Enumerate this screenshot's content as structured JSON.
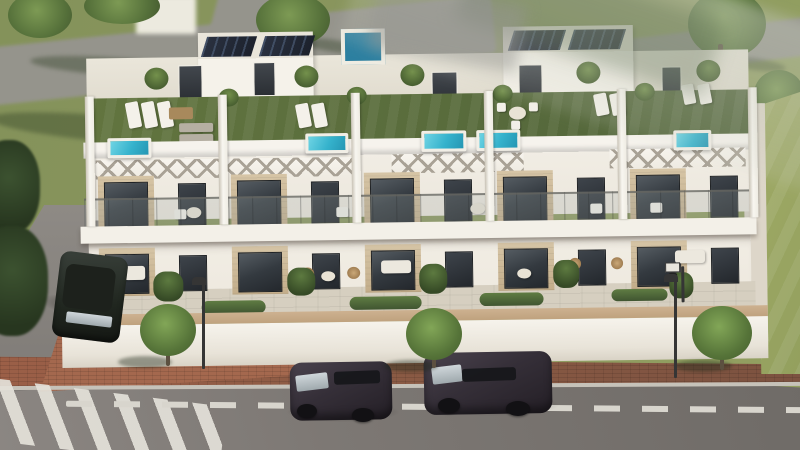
{
  "scene": {
    "description": "Aerial 3D architectural render of a terrace of five modern white townhouses with roof terraces (artificial lawn, plunge pools, loungers, pergolas), glazed balconies, ground-floor terraces behind a white boundary wall, a street in front with two dark SUVs driving, one parked car at a side street, a zebra crossing, street lamps, small trees and green lawns.",
    "visible_text": []
  },
  "palette": {
    "grass": "#84925a",
    "lawn": "#a3ad68",
    "path": "#95948c",
    "asphalt1": "#7d7874",
    "asphalt2": "#6f6b67",
    "brick": "#9b5f47",
    "wall": "#f6f3ec",
    "coping": "#cdb190",
    "facade": "#f1ede4",
    "stone": "#c3ad8a",
    "glassd": "#343a40",
    "roofgrass": "#51643a",
    "pool": "#35b2cc",
    "solar": "#1c212c",
    "pershadow": "#a9a296",
    "hedge": "#405531",
    "trunk": "#5c5040",
    "carbody": "#352f38",
    "carglass": "#cfd6da",
    "lamp": "#353535",
    "dashline": "#d8d5cd",
    "curb": "#c6c2b9"
  },
  "counts": {
    "townhouse_units": 5,
    "rooftop_pools": 5,
    "cars_driving": 2,
    "cars_parked": 1,
    "street_lamps": 2,
    "sidewalk_trees": 3
  },
  "items": [
    {
      "n": "upper-left-path",
      "c": "road-band",
      "l": "s",
      "x": -25,
      "y": 22,
      "w": 520,
      "h": 58,
      "r": -6
    },
    {
      "n": "path-branch",
      "c": "road-band",
      "l": "s",
      "x": 214,
      "y": -16,
      "w": 62,
      "h": 66,
      "r": 15
    },
    {
      "n": "upper-right-path",
      "c": "road-band",
      "l": "s",
      "x": 596,
      "y": 30,
      "w": 215,
      "h": 38,
      "r": -7
    },
    {
      "n": "grass-shadow",
      "c": "gshade",
      "l": "s",
      "x": -10,
      "y": 116,
      "w": 240,
      "h": 26,
      "r": 5
    },
    {
      "n": "grass-shadow",
      "c": "gshade",
      "l": "s",
      "x": 30,
      "y": 58,
      "w": 180,
      "h": 18,
      "r": 4
    },
    {
      "n": "tree-canopy",
      "c": "canopy",
      "l": "s",
      "x": 8,
      "y": -8,
      "w": 64,
      "h": 46
    },
    {
      "n": "tree-canopy",
      "c": "canopy",
      "l": "s",
      "x": 84,
      "y": -12,
      "w": 76,
      "h": 36
    },
    {
      "n": "tree-canopy",
      "c": "canopy",
      "l": "s",
      "x": 256,
      "y": -6,
      "w": 74,
      "h": 52
    },
    {
      "n": "tree-trunk",
      "c": "trunk",
      "l": "s",
      "x": 290,
      "y": 32,
      "w": 5,
      "h": 16
    },
    {
      "n": "tree-shadow",
      "c": "gshade",
      "l": "s",
      "x": 298,
      "y": 40,
      "w": 74,
      "h": 12,
      "r": 8
    },
    {
      "n": "tree-canopy",
      "c": "canopy",
      "l": "s",
      "x": 688,
      "y": -10,
      "w": 78,
      "h": 68
    },
    {
      "n": "tree-trunk",
      "c": "trunk",
      "l": "s",
      "x": 718,
      "y": 44,
      "w": 5,
      "h": 24
    },
    {
      "n": "tree-shadow",
      "c": "gshade",
      "l": "s",
      "x": 722,
      "y": 58,
      "w": 64,
      "h": 12,
      "r": 8
    },
    {
      "n": "tree-canopy",
      "c": "canopy",
      "l": "s",
      "x": 754,
      "y": 70,
      "w": 50,
      "h": 48
    },
    {
      "n": "roadside-bush",
      "c": "bush",
      "l": "s",
      "x": -22,
      "y": 140,
      "w": 62,
      "h": 94
    },
    {
      "n": "roadside-bush",
      "c": "bush",
      "l": "s",
      "x": -24,
      "y": 226,
      "w": 72,
      "h": 110
    },
    {
      "n": "background-building",
      "c": "bgbox",
      "l": "s",
      "x": 136,
      "y": -4,
      "w": 60,
      "h": 38
    },
    {
      "n": "roof-stair-box",
      "c": "roofbox",
      "l": "b",
      "x": 150,
      "y": 22,
      "w": 115,
      "h": 70
    },
    {
      "n": "roof-stair-box",
      "c": "roofbox",
      "l": "b",
      "x": 455,
      "y": 20,
      "w": 130,
      "h": 75
    },
    {
      "n": "solar-panel",
      "c": "solar",
      "l": "b",
      "xs": [
        156,
        214
      ],
      "y": 26,
      "w": 50,
      "h": 20
    },
    {
      "n": "solar-panel",
      "c": "solar",
      "l": "b",
      "xs": [
        463,
        523
      ],
      "y": 24,
      "w": 52,
      "h": 20
    },
    {
      "n": "roof-jacuzzi",
      "c": "jacuzzi",
      "l": "b",
      "x": 293,
      "y": 20,
      "w": 44,
      "h": 36
    },
    {
      "n": "roof-access-door",
      "c": "roofdoor",
      "l": "b",
      "x": 130,
      "y": 54,
      "w": 24,
      "h": 36
    },
    {
      "n": "roof-access-door",
      "c": "roofdoor",
      "l": "b",
      "x": 205,
      "y": 52,
      "w": 22,
      "h": 34
    },
    {
      "n": "roof-access-door",
      "c": "roofdoor",
      "l": "b",
      "x": 383,
      "y": 64,
      "w": 26,
      "h": 34
    },
    {
      "n": "roof-access-door",
      "c": "roofdoor",
      "l": "b",
      "x": 470,
      "y": 58,
      "w": 24,
      "h": 34
    },
    {
      "n": "roof-access-door",
      "c": "roofdoor",
      "l": "b",
      "x": 613,
      "y": 62,
      "w": 20,
      "h": 32
    },
    {
      "n": "roof-plant",
      "c": "plant",
      "l": "b",
      "xs": [
        96,
        246,
        352,
        528,
        648
      ],
      "y": 56,
      "w": 24,
      "h": 22
    },
    {
      "n": "roof-plant",
      "c": "plant",
      "l": "b",
      "xs": [
        170,
        298,
        444,
        586
      ],
      "y": 78,
      "w": 20,
      "h": 18
    },
    {
      "n": "sun-lounger",
      "c": "lounger",
      "l": "b",
      "xs": [
        78,
        94,
        110
      ],
      "y": 90,
      "w": 13,
      "h": 26,
      "r": -10
    },
    {
      "n": "sun-lounger",
      "c": "lounger",
      "l": "b",
      "xs": [
        248,
        264
      ],
      "y": 94,
      "w": 13,
      "h": 24,
      "r": -10
    },
    {
      "n": "sun-lounger",
      "c": "lounger",
      "l": "b",
      "xs": [
        546,
        562
      ],
      "y": 88,
      "w": 13,
      "h": 22,
      "r": -10
    },
    {
      "n": "sun-lounger",
      "c": "lounger",
      "l": "b",
      "xs": [
        634,
        650
      ],
      "y": 80,
      "w": 12,
      "h": 20,
      "r": -10
    },
    {
      "n": "sun-lounger",
      "c": "lounger-g",
      "l": "b",
      "x": 130,
      "y": 112,
      "w": 34,
      "h": 9
    },
    {
      "n": "sun-lounger",
      "c": "lounger-g",
      "l": "b",
      "x": 130,
      "y": 123,
      "w": 34,
      "h": 9
    },
    {
      "n": "coffee-table",
      "c": "woodtable",
      "l": "b",
      "x": 120,
      "y": 96,
      "w": 24,
      "h": 12
    },
    {
      "n": "roof-dining-table",
      "c": "ttable",
      "l": "b",
      "x": 460,
      "y": 100,
      "w": 17,
      "h": 13
    },
    {
      "n": "roof-chair",
      "c": "chairw",
      "l": "b",
      "xs": [
        448,
        480
      ],
      "y": 96,
      "w": 9,
      "h": 9
    },
    {
      "n": "roof-chair",
      "c": "chairw",
      "l": "b",
      "x": 462,
      "y": 114,
      "w": 9,
      "h": 9
    },
    {
      "n": "rooftop-pool",
      "c": "pool",
      "l": "b",
      "x": 58,
      "y": 126,
      "w": 44,
      "h": 20
    },
    {
      "n": "rooftop-pool",
      "c": "pool",
      "l": "b",
      "x": 256,
      "y": 124,
      "w": 43,
      "h": 20
    },
    {
      "n": "rooftop-pool",
      "c": "pool",
      "l": "b",
      "x": 372,
      "y": 123,
      "w": 45,
      "h": 21
    },
    {
      "n": "rooftop-pool",
      "c": "pool",
      "l": "b",
      "x": 427,
      "y": 123,
      "w": 44,
      "h": 21
    },
    {
      "n": "rooftop-pool",
      "c": "pool",
      "l": "b",
      "x": 624,
      "y": 126,
      "w": 38,
      "h": 20
    },
    {
      "n": "pergola",
      "c": "pergola",
      "l": "b",
      "x": 46,
      "y": 148,
      "w": 262,
      "h": 19
    },
    {
      "n": "pergola",
      "c": "pergola",
      "l": "b",
      "x": 342,
      "y": 146,
      "w": 132,
      "h": 19
    },
    {
      "n": "pergola",
      "c": "pergola",
      "l": "b",
      "x": 560,
      "y": 144,
      "w": 136,
      "h": 19
    },
    {
      "n": "window-surround",
      "c": "stone",
      "l": "b",
      "xs": [
        48,
        181,
        314,
        447,
        580
      ],
      "y": 164,
      "w": 56,
      "h": 52
    },
    {
      "n": "balcony-door-glass",
      "c": "glass",
      "l": "b",
      "xs": [
        54,
        187,
        320,
        453,
        586
      ],
      "y": 170,
      "w": 44,
      "h": 46
    },
    {
      "n": "balcony-window",
      "c": "glass2",
      "l": "b",
      "xs": [
        128,
        261,
        394,
        527,
        660
      ],
      "y": 172,
      "w": 28,
      "h": 42
    },
    {
      "n": "balcony-table",
      "c": "ttable",
      "l": "b",
      "xs": [
        136,
        420
      ],
      "y": 196,
      "w": 15,
      "h": 11
    },
    {
      "n": "balcony-chair",
      "c": "chairw",
      "l": "b",
      "xs": [
        124,
        286,
        540,
        600
      ],
      "y": 198,
      "w": 12,
      "h": 10
    },
    {
      "n": "window-surround",
      "c": "stone",
      "l": "b",
      "xs": [
        48,
        181,
        314,
        447,
        580
      ],
      "y": 236,
      "w": 56,
      "h": 48
    },
    {
      "n": "terrace-door-glass",
      "c": "glass",
      "l": "b",
      "xs": [
        54,
        187,
        320,
        453,
        586
      ],
      "y": 242,
      "w": 44,
      "h": 40
    },
    {
      "n": "terrace-window",
      "c": "glass2",
      "l": "b",
      "xs": [
        128,
        261,
        394,
        527,
        660
      ],
      "y": 244,
      "w": 28,
      "h": 36
    },
    {
      "n": "outdoor-sofa",
      "c": "sofa",
      "l": "b",
      "x": 60,
      "y": 254,
      "w": 34,
      "h": 14
    },
    {
      "n": "outdoor-sofa",
      "c": "sofa",
      "l": "b",
      "x": 330,
      "y": 252,
      "w": 30,
      "h": 13
    },
    {
      "n": "outdoor-sofa",
      "c": "sofa",
      "l": "b",
      "x": 624,
      "y": 246,
      "w": 30,
      "h": 13
    },
    {
      "n": "rattan-chair",
      "c": "rattan",
      "l": "b",
      "xs": [
        250,
        296
      ],
      "y": 258,
      "w": 13,
      "h": 12
    },
    {
      "n": "rattan-chair",
      "c": "rattan",
      "l": "b",
      "xs": [
        518,
        560
      ],
      "y": 252,
      "w": 12,
      "h": 12
    },
    {
      "n": "terrace-table",
      "c": "ttable",
      "l": "b",
      "xs": [
        270,
        466
      ],
      "y": 262,
      "w": 14,
      "h": 10
    },
    {
      "n": "terrace-palm",
      "c": "palm",
      "l": "b",
      "x": 102,
      "y": 260,
      "w": 30,
      "h": 30
    },
    {
      "n": "terrace-palm",
      "c": "palm",
      "l": "b",
      "x": 236,
      "y": 258,
      "w": 28,
      "h": 28
    },
    {
      "n": "terrace-palm",
      "c": "palm",
      "l": "b",
      "x": 368,
      "y": 256,
      "w": 28,
      "h": 30
    },
    {
      "n": "terrace-palm",
      "c": "palm",
      "l": "b",
      "x": 502,
      "y": 254,
      "w": 26,
      "h": 28
    },
    {
      "n": "terrace-palm",
      "c": "palm",
      "l": "b",
      "x": 618,
      "y": 268,
      "w": 24,
      "h": 26
    },
    {
      "n": "garden-hedge",
      "c": "hedge",
      "l": "b",
      "x": 150,
      "y": 290,
      "w": 64,
      "h": 13
    },
    {
      "n": "garden-hedge",
      "c": "hedge",
      "l": "b",
      "x": 298,
      "y": 288,
      "w": 72,
      "h": 13
    },
    {
      "n": "garden-hedge",
      "c": "hedge",
      "l": "b",
      "x": 428,
      "y": 286,
      "w": 64,
      "h": 13
    },
    {
      "n": "garden-hedge",
      "c": "hedge",
      "l": "b",
      "x": 560,
      "y": 284,
      "w": 56,
      "h": 12
    },
    {
      "n": "party-wall-fin",
      "c": "divider",
      "l": "b",
      "xs": [
        36,
        169,
        302,
        435,
        568,
        699
      ],
      "y": 84,
      "w": 9,
      "h": 130
    },
    {
      "n": "basketball-board",
      "c": "board",
      "l": "b",
      "x": 614,
      "y": 258,
      "w": 15,
      "h": 10
    },
    {
      "n": "basketball-ring",
      "c": "ring",
      "l": "b",
      "x": 617,
      "y": 268,
      "w": 9,
      "h": 5
    },
    {
      "n": "basketball-pole",
      "c": "pole",
      "l": "b",
      "x": 630,
      "y": 262,
      "w": 3,
      "h": 36
    },
    {
      "n": "street-lamp-pole",
      "c": "pole",
      "l": "s",
      "x": 202,
      "y": 281,
      "w": 3,
      "h": 88,
      "z": 35
    },
    {
      "n": "street-lamp-head",
      "c": "lamphead",
      "l": "s",
      "x": 192,
      "y": 277,
      "w": 14,
      "h": 8
    },
    {
      "n": "street-lamp-pole",
      "c": "pole",
      "l": "s",
      "x": 674,
      "y": 278,
      "w": 3,
      "h": 100,
      "z": 35
    },
    {
      "n": "street-lamp-head",
      "c": "lamphead",
      "l": "s",
      "x": 664,
      "y": 274,
      "w": 14,
      "h": 8
    },
    {
      "n": "sidewalk-tree-shadow",
      "c": "treeshadow",
      "l": "s",
      "x": 118,
      "y": 356,
      "w": 54,
      "h": 12,
      "z": 34
    },
    {
      "n": "sidewalk-tree-trunk",
      "c": "trunk",
      "l": "s",
      "x": 166,
      "y": 348,
      "w": 4,
      "h": 18,
      "z": 34
    },
    {
      "n": "sidewalk-tree",
      "c": "swcanopy",
      "l": "s",
      "x": 140,
      "y": 304,
      "w": 56,
      "h": 52,
      "z": 35
    },
    {
      "n": "sidewalk-tree-shadow",
      "c": "treeshadow",
      "l": "s",
      "x": 384,
      "y": 360,
      "w": 54,
      "h": 12,
      "z": 34
    },
    {
      "n": "sidewalk-tree-trunk",
      "c": "trunk",
      "l": "s",
      "x": 432,
      "y": 352,
      "w": 4,
      "h": 16,
      "z": 34
    },
    {
      "n": "sidewalk-tree",
      "c": "swcanopy",
      "l": "s",
      "x": 406,
      "y": 308,
      "w": 56,
      "h": 52,
      "z": 35
    },
    {
      "n": "sidewalk-tree-shadow",
      "c": "treeshadow",
      "l": "s",
      "x": 674,
      "y": 360,
      "w": 58,
      "h": 12,
      "z": 34
    },
    {
      "n": "sidewalk-tree-trunk",
      "c": "trunk",
      "l": "s",
      "x": 720,
      "y": 352,
      "w": 4,
      "h": 18,
      "z": 34
    },
    {
      "n": "sidewalk-tree",
      "c": "swcanopy",
      "l": "s",
      "x": 692,
      "y": 306,
      "w": 60,
      "h": 54,
      "z": 35
    },
    {
      "n": "car-shadow",
      "c": "carshadow",
      "l": "s",
      "x": 40,
      "y": 296,
      "w": 84,
      "h": 22,
      "r": 10,
      "z": 29
    },
    {
      "n": "parked-car-body",
      "c": "carbody-c",
      "l": "s",
      "x": 56,
      "y": 254,
      "w": 68,
      "h": 86,
      "r": 7,
      "z": 30
    },
    {
      "n": "parked-car-roof",
      "c": "carroof",
      "l": "s",
      "x": 64,
      "y": 266,
      "w": 50,
      "h": 44,
      "r": 7,
      "z": 31
    },
    {
      "n": "parked-car-windshield",
      "c": "carwind",
      "l": "s",
      "x": 66,
      "y": 314,
      "w": 46,
      "h": 11,
      "r": 7,
      "z": 31
    },
    {
      "n": "car-shadow",
      "c": "carshadow",
      "l": "s",
      "x": 286,
      "y": 402,
      "w": 114,
      "h": 20,
      "z": 29
    },
    {
      "n": "car-body",
      "c": "carbody",
      "l": "s",
      "x": 290,
      "y": 362,
      "w": 102,
      "h": 58,
      "r": -1,
      "z": 30
    },
    {
      "n": "car-windshield",
      "c": "carwind",
      "l": "s",
      "x": 296,
      "y": 374,
      "w": 32,
      "h": 16,
      "r": -7,
      "z": 31
    },
    {
      "n": "car-side-windows",
      "c": "carwin",
      "l": "s",
      "x": 334,
      "y": 371,
      "w": 46,
      "h": 13,
      "r": -2,
      "z": 31
    },
    {
      "n": "car-wheel",
      "c": "wheel",
      "l": "s",
      "x": 297,
      "y": 404,
      "w": 20,
      "h": 14,
      "z": 31
    },
    {
      "n": "car-wheel",
      "c": "wheel",
      "l": "s",
      "x": 352,
      "y": 408,
      "w": 22,
      "h": 14,
      "z": 31
    },
    {
      "n": "car-shadow",
      "c": "carshadow",
      "l": "s",
      "x": 424,
      "y": 394,
      "w": 136,
      "h": 22,
      "z": 29
    },
    {
      "n": "car-body",
      "c": "carbody",
      "l": "s",
      "x": 424,
      "y": 352,
      "w": 128,
      "h": 62,
      "r": -1,
      "z": 30
    },
    {
      "n": "car-windshield",
      "c": "carwind",
      "l": "s",
      "x": 432,
      "y": 366,
      "w": 30,
      "h": 17,
      "r": -7,
      "z": 31
    },
    {
      "n": "car-side-windows",
      "c": "carwin",
      "l": "s",
      "x": 462,
      "y": 368,
      "w": 54,
      "h": 13,
      "r": -2,
      "z": 31
    },
    {
      "n": "car-wheel",
      "c": "wheel",
      "l": "s",
      "x": 438,
      "y": 398,
      "w": 22,
      "h": 15,
      "z": 31
    },
    {
      "n": "car-wheel",
      "c": "wheel",
      "l": "s",
      "x": 506,
      "y": 401,
      "w": 24,
      "h": 15,
      "z": 31
    }
  ]
}
